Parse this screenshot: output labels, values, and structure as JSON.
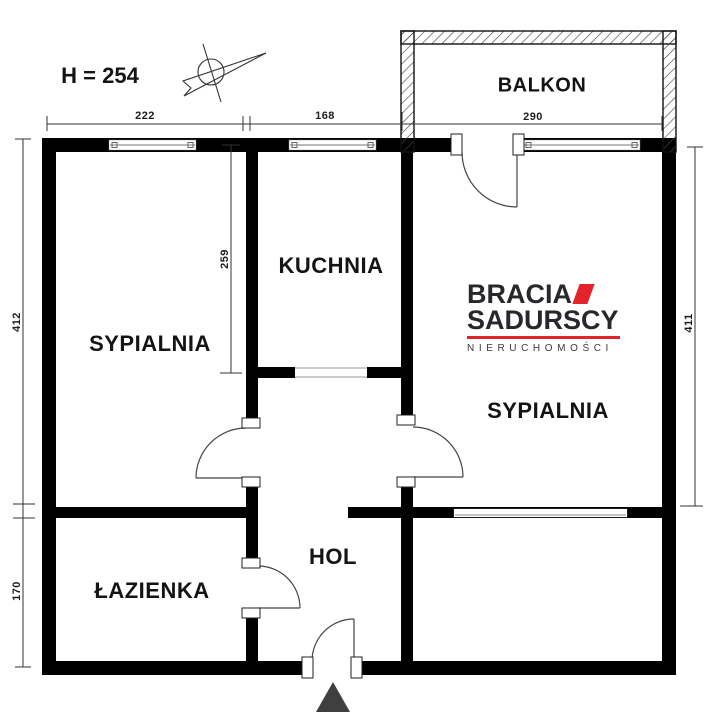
{
  "plan": {
    "height_note": "H = 254",
    "rooms": {
      "balkon": "BALKON",
      "kuchnia": "KUCHNIA",
      "sypialnia_left": "SYPIALNIA",
      "sypialnia_right": "SYPIALNIA",
      "lazienka": "ŁAZIENKA",
      "hol": "HOL"
    },
    "dimensions": {
      "top_left": "222",
      "top_middle": "168",
      "top_right": "290",
      "left_upper": "412",
      "left_lower": "170",
      "right": "411",
      "kitchen_wall": "259"
    },
    "logo": {
      "line1": "BRACIA",
      "line2": "SADURSCY",
      "line3": "NIERUCHOMOŚCI"
    },
    "icons": {
      "north_arrow": "compass-needle",
      "entrance_marker": "triangle-up"
    },
    "colors": {
      "wall": "#000000",
      "door_line": "#444444",
      "dimension_line": "#333333",
      "logo_red": "#e2232a",
      "logo_text": "#28282c",
      "entrance_marker": "#3f3f3f"
    }
  }
}
